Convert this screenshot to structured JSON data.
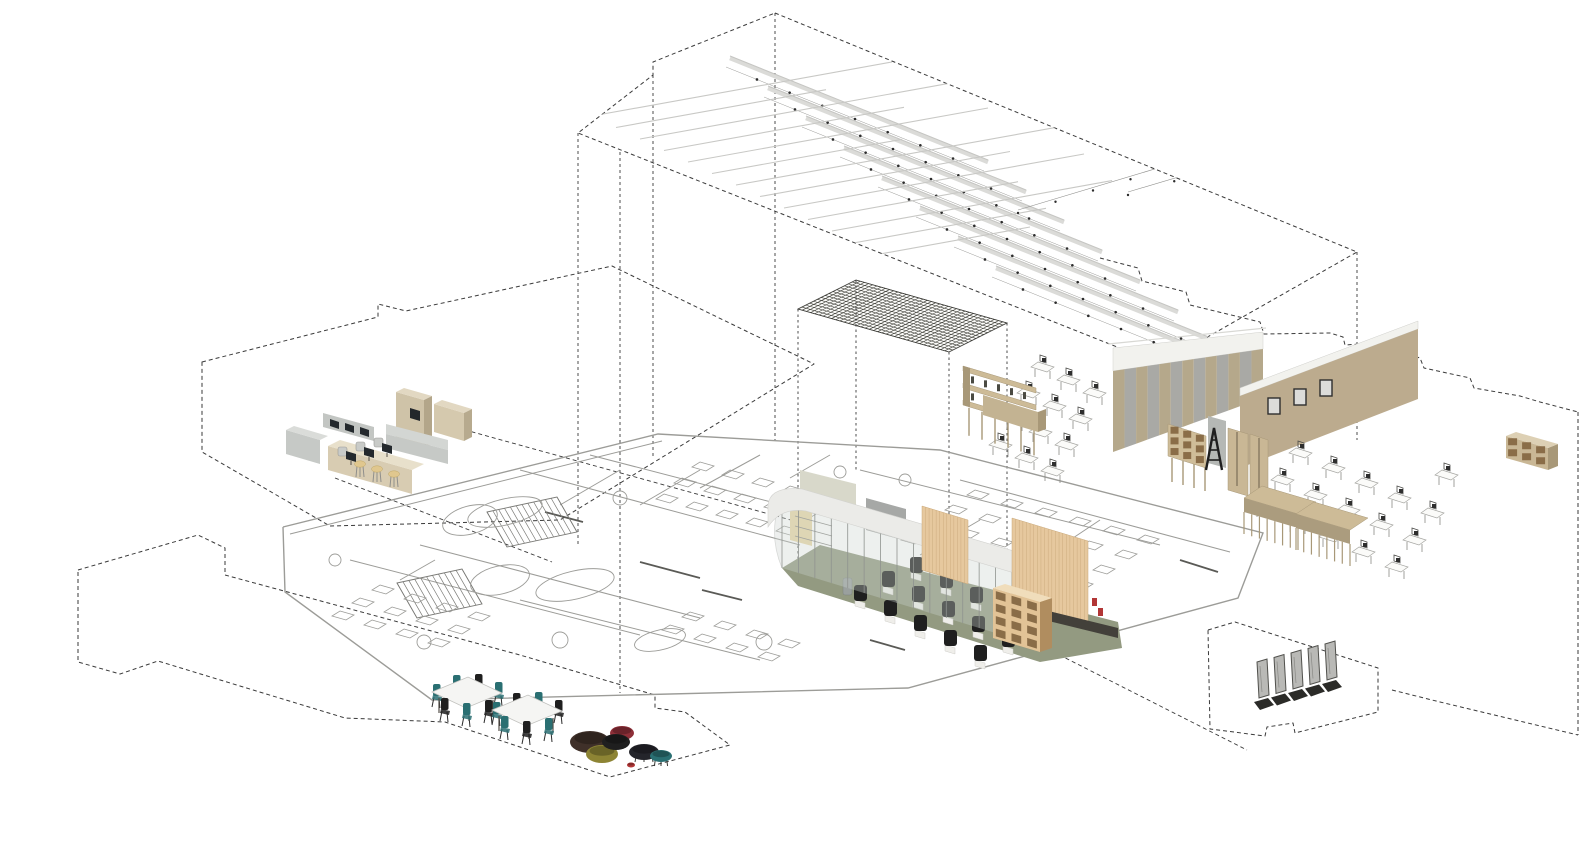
{
  "meta": {
    "description": "Exploded axonometric interior diagram of a library learning centre",
    "canvas": {
      "w": 1582,
      "h": 845,
      "bg": "#ffffff"
    }
  },
  "colors": {
    "dash": "#3a3a3a",
    "planLine": "#9c9c98",
    "planDark": "#5a5a56",
    "baffle": "#dbdbd8",
    "baffleEdge": "#c6c6c3",
    "thinLine": "#c8c8c5",
    "dot": "#2c2c2c",
    "hatch": "#3f3f38",
    "tan": "#cfc3a8",
    "tanTop": "#e2d8c2",
    "tanSide": "#b3a68a",
    "wood": "#e6c89e",
    "woodDark": "#c9a87a",
    "shelfTan": "#cdbb97",
    "shelfSide": "#a89878",
    "holeBrown": "#8a6d48",
    "grayCounter": "#c6c9c6",
    "grayCounterTop": "#dadcd9",
    "monitor": "#24292d",
    "stool": "#e0c78e",
    "sage": "#d8d8ca",
    "partition": "#a6a8a6",
    "fascia": "#ebebe8",
    "fasciaEdge": "#d2d2cf",
    "glass": "#ccd4cf",
    "mullion": "#8f938f",
    "olive": "#939a81",
    "plinth": "#43403a",
    "chairBlack": "#1f1f1f",
    "chairBase": "#efeeea",
    "teal": "#2a6f72",
    "stripeTan": "#b5a88b",
    "stripeGray": "#a9a9a5",
    "bandWhite": "#f2f2ee",
    "wallTan": "#bcab8e",
    "deskTop": "#fbfbf9",
    "deskLine": "#a5a5a1",
    "gatePanel": "#b9b9b6",
    "gateBase": "#2b2b28",
    "tableTop": "#f5f5f3",
    "poufBrown": "#3f3029",
    "poufOlive": "#8d8434",
    "poufMaroon": "#8e2f38",
    "poufBlack": "#24252b",
    "redAccent": "#b23636",
    "yellowWall": "#e8d8a8",
    "binGray": "#9aa09e"
  },
  "scene": {
    "upper_volume": {
      "top_face": "775,13 1357,252 1160,364 578,133 653,75 653,62",
      "verticals": [
        [
          578,
          133,
          545
        ],
        [
          620,
          152,
          693
        ],
        [
          653,
          75,
          458
        ],
        [
          775,
          13,
          440
        ],
        [
          1357,
          252,
          440
        ],
        [
          1160,
          364,
          428
        ]
      ]
    },
    "ceiling_lights": {
      "bars": {
        "count": 8,
        "start": [
          730,
          58
        ],
        "step": [
          38,
          30
        ],
        "delta": [
          258,
          104
        ],
        "dots": 7,
        "dotOffset": [
          -4,
          9
        ]
      },
      "thin_lines": {
        "count": 13,
        "start": [
          592,
          116
        ],
        "step": [
          24,
          11.5
        ],
        "slope": -0.18,
        "lengths": [
          300,
          210,
          330,
          240,
          300,
          190,
          330,
          250,
          300,
          210,
          280,
          190,
          150
        ]
      },
      "dot_lines": [
        [
          1018,
          210,
          150,
          -45
        ],
        [
          1128,
          192,
          185,
          -55
        ],
        [
          1232,
          168,
          130,
          -38
        ]
      ]
    },
    "canopy": {
      "quad": {
        "W": [
          798,
          309
        ],
        "N": [
          856,
          280
        ],
        "S": [
          949,
          352
        ],
        "E": [
          1007,
          323
        ],
        "hatchA": 36,
        "hatchB": 15
      },
      "projection_lines": [
        [
          798,
          309,
          560
        ],
        [
          856,
          280,
          470
        ],
        [
          949,
          352,
          652
        ],
        [
          1007,
          323,
          560
        ]
      ]
    },
    "plates": {
      "reception": "202,362 378,317 378,304 406,311 612,266 814,364 560,520 330,526 202,452",
      "bottom_left": "78,570 198,535 225,548 225,575 520,655 655,695 655,708 685,712 730,745 610,777 445,722 345,718 158,661 120,674 78,662",
      "gates": "1208,630 1235,622 1378,668 1378,712 1295,733 1293,723 1267,727 1265,736 1210,729",
      "right_steps": "1100,258 1138,268 1142,281 1186,292 1190,305 1260,322 1264,334 1330,333 1343,337 1345,345 1375,343 1420,358 1424,368 1470,378 1474,388 1520,396 1540,402 1578,412",
      "right_edge": [
        1578,
        412,
        735
      ],
      "right_bottom": "1392,690 1440,702 1578,735",
      "stray_lines": [
        [
          872,
          560,
          1247,
          750
        ],
        [
          458,
          428,
          798,
          522
        ],
        [
          335,
          478,
          552,
          562
        ]
      ]
    },
    "floor_plan": {
      "boundary": "283,527 658,434 940,450 1263,533 1238,598 908,688 432,700 285,592 283,527",
      "inner_edge": [
        290,
        534,
        662,
        441
      ],
      "walls": [
        [
          350,
          560,
          640,
          635
        ],
        [
          420,
          545,
          700,
          618
        ],
        [
          520,
          470,
          800,
          545
        ],
        [
          590,
          455,
          860,
          525
        ],
        [
          700,
          470,
          640,
          505
        ],
        [
          760,
          455,
          700,
          488
        ],
        [
          860,
          470,
          1160,
          545
        ],
        [
          960,
          480,
          1230,
          552
        ],
        [
          520,
          600,
          760,
          660
        ],
        [
          620,
          470,
          560,
          505
        ],
        [
          980,
          520,
          920,
          555
        ],
        [
          1100,
          520,
          1040,
          560
        ],
        [
          435,
          560,
          400,
          580
        ],
        [
          830,
          455,
          790,
          478
        ]
      ],
      "dark_segments": [
        [
          640,
          562,
          700,
          578
        ],
        [
          702,
          590,
          742,
          600
        ],
        [
          1180,
          560,
          1218,
          572
        ],
        [
          545,
          512,
          583,
          522
        ],
        [
          870,
          640,
          905,
          650
        ]
      ],
      "stairs": [
        {
          "a": [
            487,
            512
          ],
          "b": [
            557,
            497
          ],
          "d": [
            20,
            35
          ],
          "n": 12
        },
        {
          "a": [
            397,
            583
          ],
          "b": [
            462,
            569
          ],
          "d": [
            20,
            35
          ],
          "n": 11
        }
      ],
      "railings": [
        [
          470,
          520,
          28,
          14,
          -15
        ],
        [
          500,
          580,
          30,
          14,
          -13
        ]
      ],
      "ovals": [
        [
          505,
          512,
          38,
          13,
          -13
        ],
        [
          575,
          585,
          40,
          14,
          -13
        ],
        [
          660,
          640,
          26,
          10,
          -13
        ]
      ],
      "circles": [
        [
          620,
          498,
          7
        ],
        [
          560,
          640,
          8
        ],
        [
          764,
          642,
          8
        ],
        [
          1060,
          600,
          8
        ],
        [
          424,
          642,
          7
        ],
        [
          840,
          472,
          6
        ],
        [
          905,
          480,
          6
        ],
        [
          335,
          560,
          6
        ]
      ],
      "furniture_bands": [
        {
          "origin": [
            700,
            462
          ],
          "rows": 3,
          "cols": 5,
          "rowStep": [
            -18,
            16
          ],
          "colStep": [
            30,
            8
          ]
        },
        {
          "origin": [
            975,
            490
          ],
          "rows": 4,
          "cols": 6,
          "rowStep": [
            -22,
            15
          ],
          "colStep": [
            34,
            9
          ]
        },
        {
          "origin": [
            380,
            585
          ],
          "rows": 3,
          "cols": 4,
          "rowStep": [
            -20,
            13
          ],
          "colStep": [
            32,
            9
          ]
        },
        {
          "origin": [
            690,
            612
          ],
          "rows": 2,
          "cols": 4,
          "rowStep": [
            -20,
            13
          ],
          "colStep": [
            32,
            9
          ]
        }
      ]
    },
    "reception_desk": {
      "back_panel": {
        "front": "396,392 424,400 424,448 396,440",
        "top": "396,392 404,388 432,396 424,400",
        "side": "424,400 432,396 432,444 424,448"
      },
      "niche": "410,408 420,411 420,421 410,418",
      "overhead": {
        "bar": "323,413 374,427 374,441 323,427",
        "monitors": [
          [
            330,
            419
          ],
          [
            345,
            423
          ],
          [
            360,
            427
          ]
        ]
      },
      "left_counter": {
        "front": "286,430 320,440 320,464 286,454",
        "top": "286,430 294,426 328,436 320,440"
      },
      "main_counter": {
        "top": "328,446 340,440 424,464 412,470",
        "front": "328,446 412,470 412,494 328,470"
      },
      "right_return": {
        "top": "386,424 448,440 448,450 386,434",
        "front": "386,434 448,450 448,464 386,448"
      },
      "right_block": {
        "front": "434,404 464,413 464,441 434,432",
        "top": "434,404 442,400 472,409 464,413",
        "side": "464,413 472,409 472,437 464,441"
      },
      "monitors": [
        [
          346,
          451
        ],
        [
          364,
          447
        ],
        [
          382,
          443
        ]
      ],
      "chairs": [
        [
          338,
          447
        ],
        [
          356,
          442
        ],
        [
          374,
          438
        ]
      ],
      "stools": [
        [
          360,
          464
        ],
        [
          377,
          469
        ],
        [
          394,
          474
        ]
      ]
    },
    "pavilion": {
      "floor": "782,568 820,545 1118,622 1122,648 1040,662 798,586",
      "sage_wall": "800,470 856,484 856,509 800,495",
      "partition": "866,498 906,509 906,541 866,530",
      "yellow_wall": "790,505 812,511 812,546 790,540",
      "shelf_lines": [
        [
          795,
          516,
          832,
          526
        ],
        [
          795,
          526,
          832,
          536
        ],
        [
          795,
          536,
          832,
          546
        ]
      ],
      "bin": [
        843,
        578,
        9,
        17
      ],
      "chair_rows": {
        "rows": [
          [
            856,
            594
          ],
          [
            884,
            580
          ],
          [
            912,
            566
          ]
        ],
        "cols": 5,
        "colStep": [
          30,
          15
        ]
      },
      "glass": {
        "x0": 782,
        "x1": 1012,
        "topY0": 496,
        "slope": 0.3043,
        "height": 72,
        "mullions": 14
      },
      "fascia_path": "M768,505 Q770,486 802,489 L1048,561 L1048,583 L806,511 Q781,507 768,527 Z",
      "slat_wall_a": "922,506 968,520 968,584 922,570",
      "slat_wall_b": "1012,518 1088,541 1088,627 1012,604",
      "plinth": "1012,602 1118,628 1118,638 1012,612",
      "cubby": {
        "front": "993,588 1040,602 1040,652 993,638",
        "side": "1040,602 1052,598 1052,648 1040,652",
        "top": "993,588 1005,584 1052,598 1040,602",
        "cols": 3,
        "rows": 4
      },
      "red_books": [
        [
          1092,
          598
        ],
        [
          1098,
          608
        ]
      ]
    },
    "library": {
      "striped_wall": {
        "x0": 1113,
        "x1": 1263,
        "topY0": 348,
        "topY1": 332,
        "stripeTopY0": 371,
        "stripeTopY1": 349,
        "botY0": 452,
        "botY1": 398,
        "stripes": 13
      },
      "tan_wall": {
        "face": "1240,396 1418,329 1418,399 1240,468",
        "band": "1240,388 1418,321 1418,329 1240,396"
      },
      "desk_groups": [
        {
          "origin": [
            1038,
            362
          ],
          "rows": 4,
          "cols": 3,
          "rowStep": [
            -14,
            26
          ],
          "colStep": [
            26,
            13
          ]
        },
        {
          "origin": [
            1296,
            448
          ],
          "rows": 3,
          "cols": 5,
          "rowStep": [
            -18,
            27
          ],
          "colStep": [
            33,
            15
          ]
        }
      ],
      "shelf_on_legs": {
        "x": 963,
        "y": 366,
        "w": 73,
        "dy": 22,
        "slabs": 3,
        "gap": 17,
        "legDrop": 28
      },
      "bench_front": {
        "top": "983,395 1038,412 1038,432 983,415",
        "side": "1038,412 1046,409 1046,429 1038,432"
      },
      "cubby_on_legs": {
        "front": "1168,424 1206,436 1206,468 1168,456",
        "cols": 3,
        "rows": 3,
        "legDrop": 24
      },
      "gray_panel": "1208,416 1226,421 1226,468 1208,463",
      "ladder": {
        "x": 1206,
        "y": 470,
        "w": 16,
        "h": 42
      },
      "cabinets": [
        [
          "1228,428 1248,434 1248,496 1228,490"
        ],
        [
          "1250,434 1268,440 1268,500 1250,494"
        ]
      ],
      "display_panels": [
        [
          1268,
          398
        ],
        [
          1294,
          389
        ],
        [
          1320,
          380
        ]
      ],
      "benches": [
        {
          "dx": 0,
          "dy": 0
        },
        {
          "dx": 52,
          "dy": 16
        }
      ],
      "bench_base": {
        "top": "1262,486 1316,502 1298,514 1244,498",
        "drop": 14,
        "legs": 8,
        "legDrop": 22
      },
      "far_shelf": {
        "front": "1506,436 1548,448 1548,470 1506,458",
        "side": "1548,448 1558,444 1558,466 1548,470",
        "top": "1506,436 1516,432 1558,444 1548,448",
        "cols": 3,
        "rows": 2
      },
      "far_chair": [
        1442,
        470
      ]
    },
    "cafe": {
      "tables": [
        {
          "anchor": [
            467,
            692
          ],
          "chairs": [
            [
              -34,
              -4,
              "teal"
            ],
            [
              -14,
              -13,
              "teal"
            ],
            [
              8,
              -14,
              "black"
            ],
            [
              28,
              -6,
              "teal"
            ],
            [
              -26,
              10,
              "black"
            ],
            [
              -4,
              15,
              "teal"
            ],
            [
              18,
              12,
              "black"
            ]
          ]
        },
        {
          "anchor": [
            527,
            710
          ],
          "chairs": [
            [
              -34,
              -4,
              "teal"
            ],
            [
              -14,
              -13,
              "black"
            ],
            [
              8,
              -14,
              "teal"
            ],
            [
              28,
              -6,
              "black"
            ],
            [
              -26,
              10,
              "teal"
            ],
            [
              -4,
              15,
              "black"
            ],
            [
              18,
              12,
              "teal"
            ]
          ]
        }
      ],
      "table_shape": [
        [
          -35,
          0
        ],
        [
          1,
          -15
        ],
        [
          35,
          1
        ],
        [
          -1,
          16
        ]
      ],
      "poufs": [
        [
          590,
          742,
          20,
          11,
          "poufBrown",
          0
        ],
        [
          602,
          754,
          16,
          9,
          "poufOlive",
          0
        ],
        [
          622,
          733,
          12,
          7,
          "poufMaroon",
          1
        ],
        [
          616,
          742,
          14,
          8,
          "chairBlack",
          0
        ],
        [
          644,
          752,
          15,
          8,
          "poufBlack",
          1
        ],
        [
          661,
          756,
          11,
          6,
          "teal",
          1
        ],
        [
          631,
          765,
          4,
          2.5,
          "redAccent",
          0
        ]
      ]
    },
    "gates": {
      "origin": [
        1256,
        700
      ],
      "step": [
        17,
        -4.5
      ],
      "count": 5
    }
  }
}
